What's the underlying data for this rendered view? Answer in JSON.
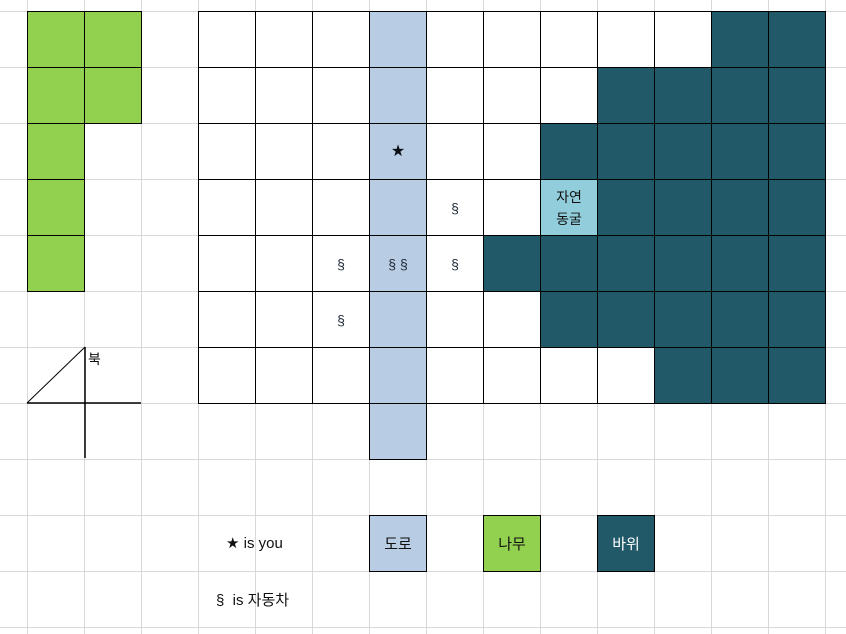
{
  "colors": {
    "tree": "#92d050",
    "rock": "#215968",
    "road": "#b8cce4",
    "cave": "#92cddc",
    "gridline": "#d9d9d9",
    "cell_border": "#000000"
  },
  "compass": {
    "label": "북"
  },
  "cave": {
    "line1": "자연",
    "line2": "동굴"
  },
  "legend": {
    "player": "★ is you",
    "car": "§  is 자동차",
    "road": "도로",
    "tree": "나무",
    "rock": "바위"
  },
  "map": {
    "cells": [
      {
        "c": 0,
        "r": 0,
        "t": "t"
      },
      {
        "c": 1,
        "r": 0,
        "t": "t"
      },
      {
        "c": 0,
        "r": 1,
        "t": "t"
      },
      {
        "c": 1,
        "r": 1,
        "t": "t"
      },
      {
        "c": 0,
        "r": 2,
        "t": "t"
      },
      {
        "c": 0,
        "r": 3,
        "t": "t"
      },
      {
        "c": 0,
        "r": 4,
        "t": "t"
      },
      {
        "c": 3,
        "r": 0,
        "t": "e"
      },
      {
        "c": 4,
        "r": 0,
        "t": "e"
      },
      {
        "c": 5,
        "r": 0,
        "t": "e"
      },
      {
        "c": 6,
        "r": 0,
        "t": "d"
      },
      {
        "c": 7,
        "r": 0,
        "t": "e"
      },
      {
        "c": 8,
        "r": 0,
        "t": "e"
      },
      {
        "c": 9,
        "r": 0,
        "t": "e"
      },
      {
        "c": 10,
        "r": 0,
        "t": "e"
      },
      {
        "c": 11,
        "r": 0,
        "t": "e"
      },
      {
        "c": 12,
        "r": 0,
        "t": "r"
      },
      {
        "c": 13,
        "r": 0,
        "t": "r"
      },
      {
        "c": 3,
        "r": 1,
        "t": "e"
      },
      {
        "c": 4,
        "r": 1,
        "t": "e"
      },
      {
        "c": 5,
        "r": 1,
        "t": "e"
      },
      {
        "c": 6,
        "r": 1,
        "t": "d"
      },
      {
        "c": 7,
        "r": 1,
        "t": "e"
      },
      {
        "c": 8,
        "r": 1,
        "t": "e"
      },
      {
        "c": 9,
        "r": 1,
        "t": "e"
      },
      {
        "c": 10,
        "r": 1,
        "t": "r"
      },
      {
        "c": 11,
        "r": 1,
        "t": "r"
      },
      {
        "c": 12,
        "r": 1,
        "t": "r"
      },
      {
        "c": 13,
        "r": 1,
        "t": "r"
      },
      {
        "c": 3,
        "r": 2,
        "t": "e"
      },
      {
        "c": 4,
        "r": 2,
        "t": "e"
      },
      {
        "c": 5,
        "r": 2,
        "t": "e"
      },
      {
        "c": 6,
        "r": 2,
        "t": "d",
        "s": "★"
      },
      {
        "c": 7,
        "r": 2,
        "t": "e"
      },
      {
        "c": 8,
        "r": 2,
        "t": "e"
      },
      {
        "c": 9,
        "r": 2,
        "t": "r"
      },
      {
        "c": 10,
        "r": 2,
        "t": "r"
      },
      {
        "c": 11,
        "r": 2,
        "t": "r"
      },
      {
        "c": 12,
        "r": 2,
        "t": "r"
      },
      {
        "c": 13,
        "r": 2,
        "t": "r"
      },
      {
        "c": 3,
        "r": 3,
        "t": "e"
      },
      {
        "c": 4,
        "r": 3,
        "t": "e"
      },
      {
        "c": 5,
        "r": 3,
        "t": "e"
      },
      {
        "c": 6,
        "r": 3,
        "t": "d"
      },
      {
        "c": 7,
        "r": 3,
        "t": "e",
        "s": "§"
      },
      {
        "c": 8,
        "r": 3,
        "t": "e"
      },
      {
        "c": 9,
        "r": 3,
        "t": "c"
      },
      {
        "c": 10,
        "r": 3,
        "t": "r"
      },
      {
        "c": 11,
        "r": 3,
        "t": "r"
      },
      {
        "c": 12,
        "r": 3,
        "t": "r"
      },
      {
        "c": 13,
        "r": 3,
        "t": "r"
      },
      {
        "c": 3,
        "r": 4,
        "t": "e"
      },
      {
        "c": 4,
        "r": 4,
        "t": "e"
      },
      {
        "c": 5,
        "r": 4,
        "t": "e",
        "s": "§"
      },
      {
        "c": 6,
        "r": 4,
        "t": "d",
        "s": "§ §"
      },
      {
        "c": 7,
        "r": 4,
        "t": "e",
        "s": "§"
      },
      {
        "c": 8,
        "r": 4,
        "t": "r"
      },
      {
        "c": 9,
        "r": 4,
        "t": "r"
      },
      {
        "c": 10,
        "r": 4,
        "t": "r"
      },
      {
        "c": 11,
        "r": 4,
        "t": "r"
      },
      {
        "c": 12,
        "r": 4,
        "t": "r"
      },
      {
        "c": 13,
        "r": 4,
        "t": "r"
      },
      {
        "c": 3,
        "r": 5,
        "t": "e"
      },
      {
        "c": 4,
        "r": 5,
        "t": "e"
      },
      {
        "c": 5,
        "r": 5,
        "t": "e",
        "s": "§"
      },
      {
        "c": 6,
        "r": 5,
        "t": "d"
      },
      {
        "c": 7,
        "r": 5,
        "t": "e"
      },
      {
        "c": 8,
        "r": 5,
        "t": "e"
      },
      {
        "c": 9,
        "r": 5,
        "t": "r"
      },
      {
        "c": 10,
        "r": 5,
        "t": "r"
      },
      {
        "c": 11,
        "r": 5,
        "t": "r"
      },
      {
        "c": 12,
        "r": 5,
        "t": "r"
      },
      {
        "c": 13,
        "r": 5,
        "t": "r"
      },
      {
        "c": 3,
        "r": 6,
        "t": "e"
      },
      {
        "c": 4,
        "r": 6,
        "t": "e"
      },
      {
        "c": 5,
        "r": 6,
        "t": "e"
      },
      {
        "c": 6,
        "r": 6,
        "t": "d"
      },
      {
        "c": 7,
        "r": 6,
        "t": "e"
      },
      {
        "c": 8,
        "r": 6,
        "t": "e"
      },
      {
        "c": 9,
        "r": 6,
        "t": "e"
      },
      {
        "c": 10,
        "r": 6,
        "t": "e"
      },
      {
        "c": 11,
        "r": 6,
        "t": "r"
      },
      {
        "c": 12,
        "r": 6,
        "t": "r"
      },
      {
        "c": 13,
        "r": 6,
        "t": "r"
      },
      {
        "c": 6,
        "r": 7,
        "t": "d"
      }
    ]
  }
}
